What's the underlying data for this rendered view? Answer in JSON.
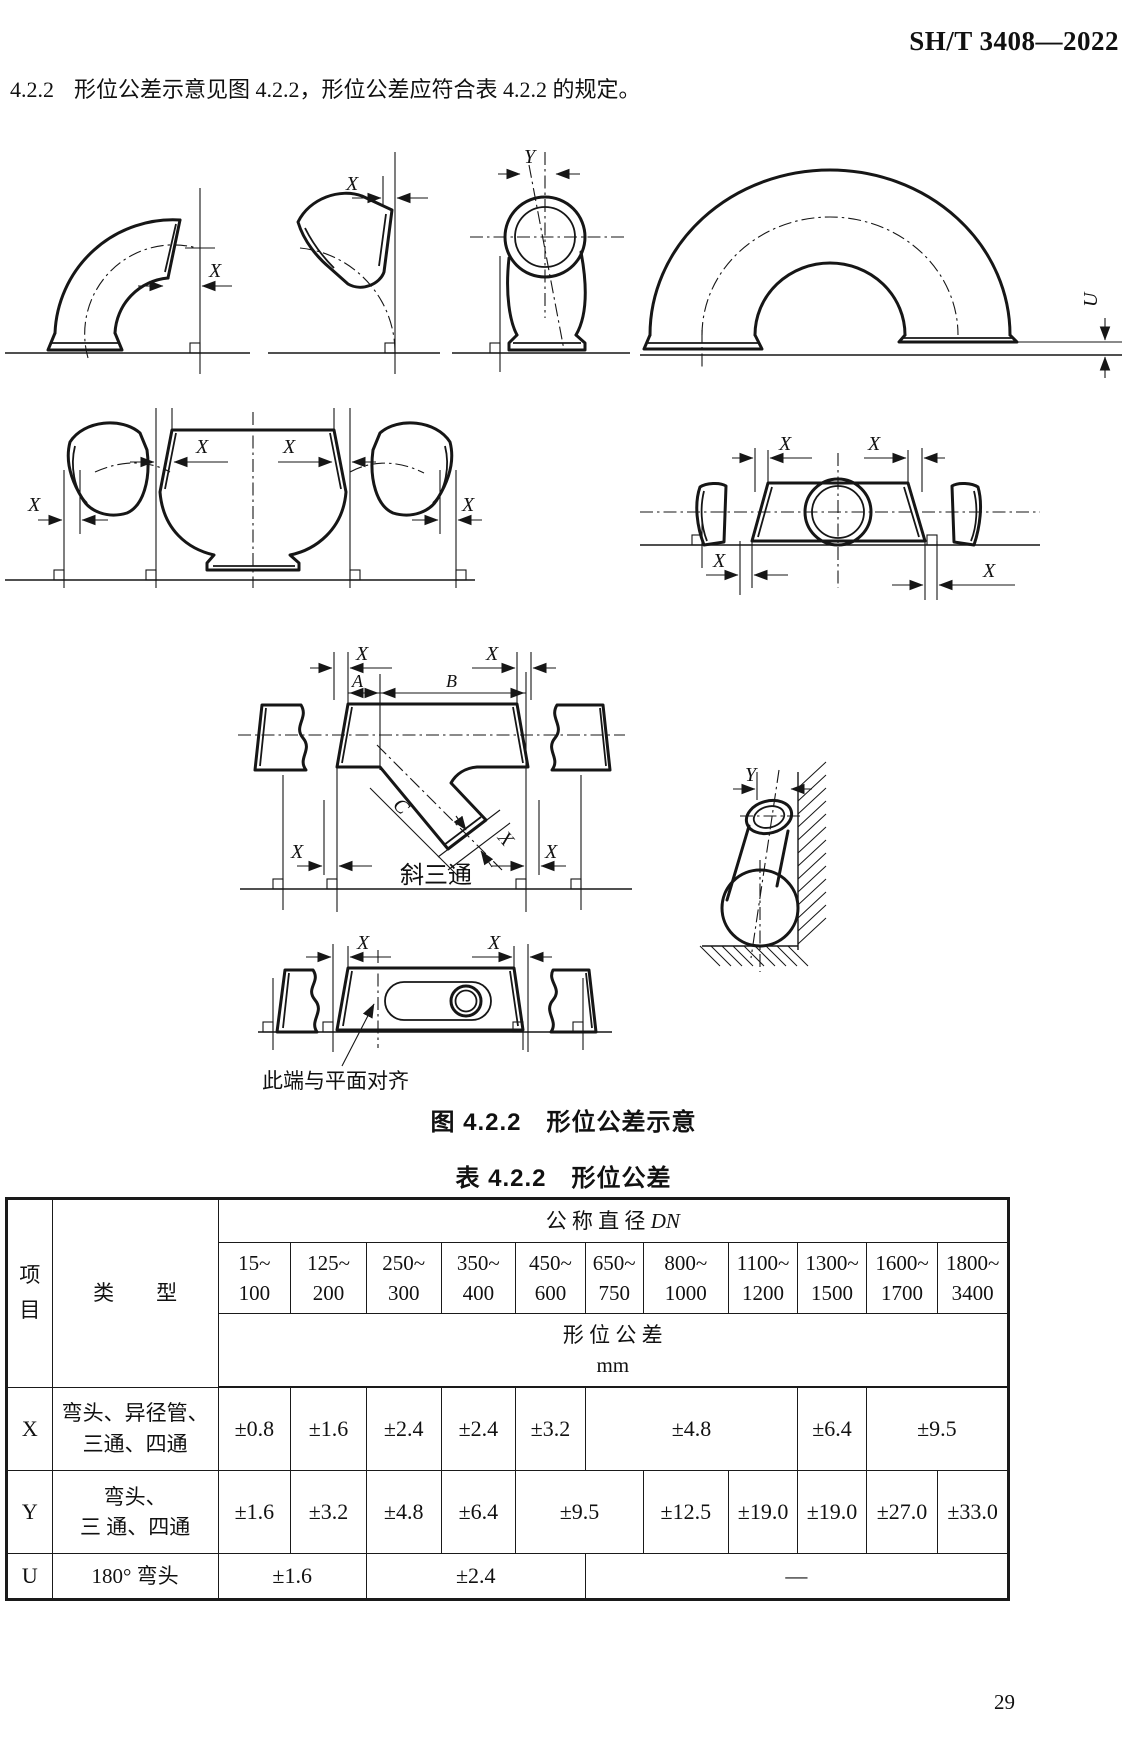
{
  "page": {
    "doc_number": "SH/T 3408—2022",
    "clause": "4.2.2",
    "clause_text": "形位公差示意见图 4.2.2，形位公差应符合表 4.2.2 的规定。",
    "page_number": "29"
  },
  "figure": {
    "caption": "图 4.2.2　形位公差示意",
    "dim_x": "X",
    "dim_y": "Y",
    "dim_u": "U",
    "dim_a": "A",
    "dim_b": "B",
    "dim_c": "C",
    "lateral_tee_label": "斜三通",
    "align_note": "此端与平面对齐"
  },
  "table": {
    "caption": "表 4.2.2　形位公差",
    "header": {
      "item": "项目",
      "type": "类　　型",
      "dn_label": "公 称 直 径 ",
      "dn_symbol": "DN",
      "tolerance_label": "形 位 公 差",
      "unit": "mm"
    },
    "dn_columns": [
      {
        "line1": "15~",
        "line2": "100"
      },
      {
        "line1": "125~",
        "line2": "200"
      },
      {
        "line1": "250~",
        "line2": "300"
      },
      {
        "line1": "350~",
        "line2": "400"
      },
      {
        "line1": "450~",
        "line2": "600"
      },
      {
        "line1": "650~",
        "line2": "750"
      },
      {
        "line1": "800~",
        "line2": "1000"
      },
      {
        "line1": "1100~",
        "line2": "1200"
      },
      {
        "line1": "1300~",
        "line2": "1500"
      },
      {
        "line1": "1600~",
        "line2": "1700"
      },
      {
        "line1": "1800~",
        "line2": "3400"
      }
    ],
    "rows": [
      {
        "item": "X",
        "type_line1": "弯头、异径管、",
        "type_line2": "三通、四通",
        "cells": [
          {
            "value": "±0.8",
            "span": 1
          },
          {
            "value": "±1.6",
            "span": 1
          },
          {
            "value": "±2.4",
            "span": 1
          },
          {
            "value": "±2.4",
            "span": 1
          },
          {
            "value": "±3.2",
            "span": 1
          },
          {
            "value": "±4.8",
            "span": 3
          },
          {
            "value": "±6.4",
            "span": 1
          },
          {
            "value": "±9.5",
            "span": 2
          }
        ]
      },
      {
        "item": "Y",
        "type_line1": "弯头、",
        "type_line2": "三 通、四通",
        "cells": [
          {
            "value": "±1.6",
            "span": 1
          },
          {
            "value": "±3.2",
            "span": 1
          },
          {
            "value": "±4.8",
            "span": 1
          },
          {
            "value": "±6.4",
            "span": 1
          },
          {
            "value": "±9.5",
            "span": 2
          },
          {
            "value": "±12.5",
            "span": 1
          },
          {
            "value": "±19.0",
            "span": 1
          },
          {
            "value": "±19.0",
            "span": 1
          },
          {
            "value": "±27.0",
            "span": 1
          },
          {
            "value": "±33.0",
            "span": 1
          }
        ]
      },
      {
        "item": "U",
        "type_line1": "180° 弯头",
        "type_line2": "",
        "cells": [
          {
            "value": "±1.6",
            "span": 2
          },
          {
            "value": "±2.4",
            "span": 3
          },
          {
            "value": "—",
            "span": 6
          }
        ]
      }
    ]
  }
}
